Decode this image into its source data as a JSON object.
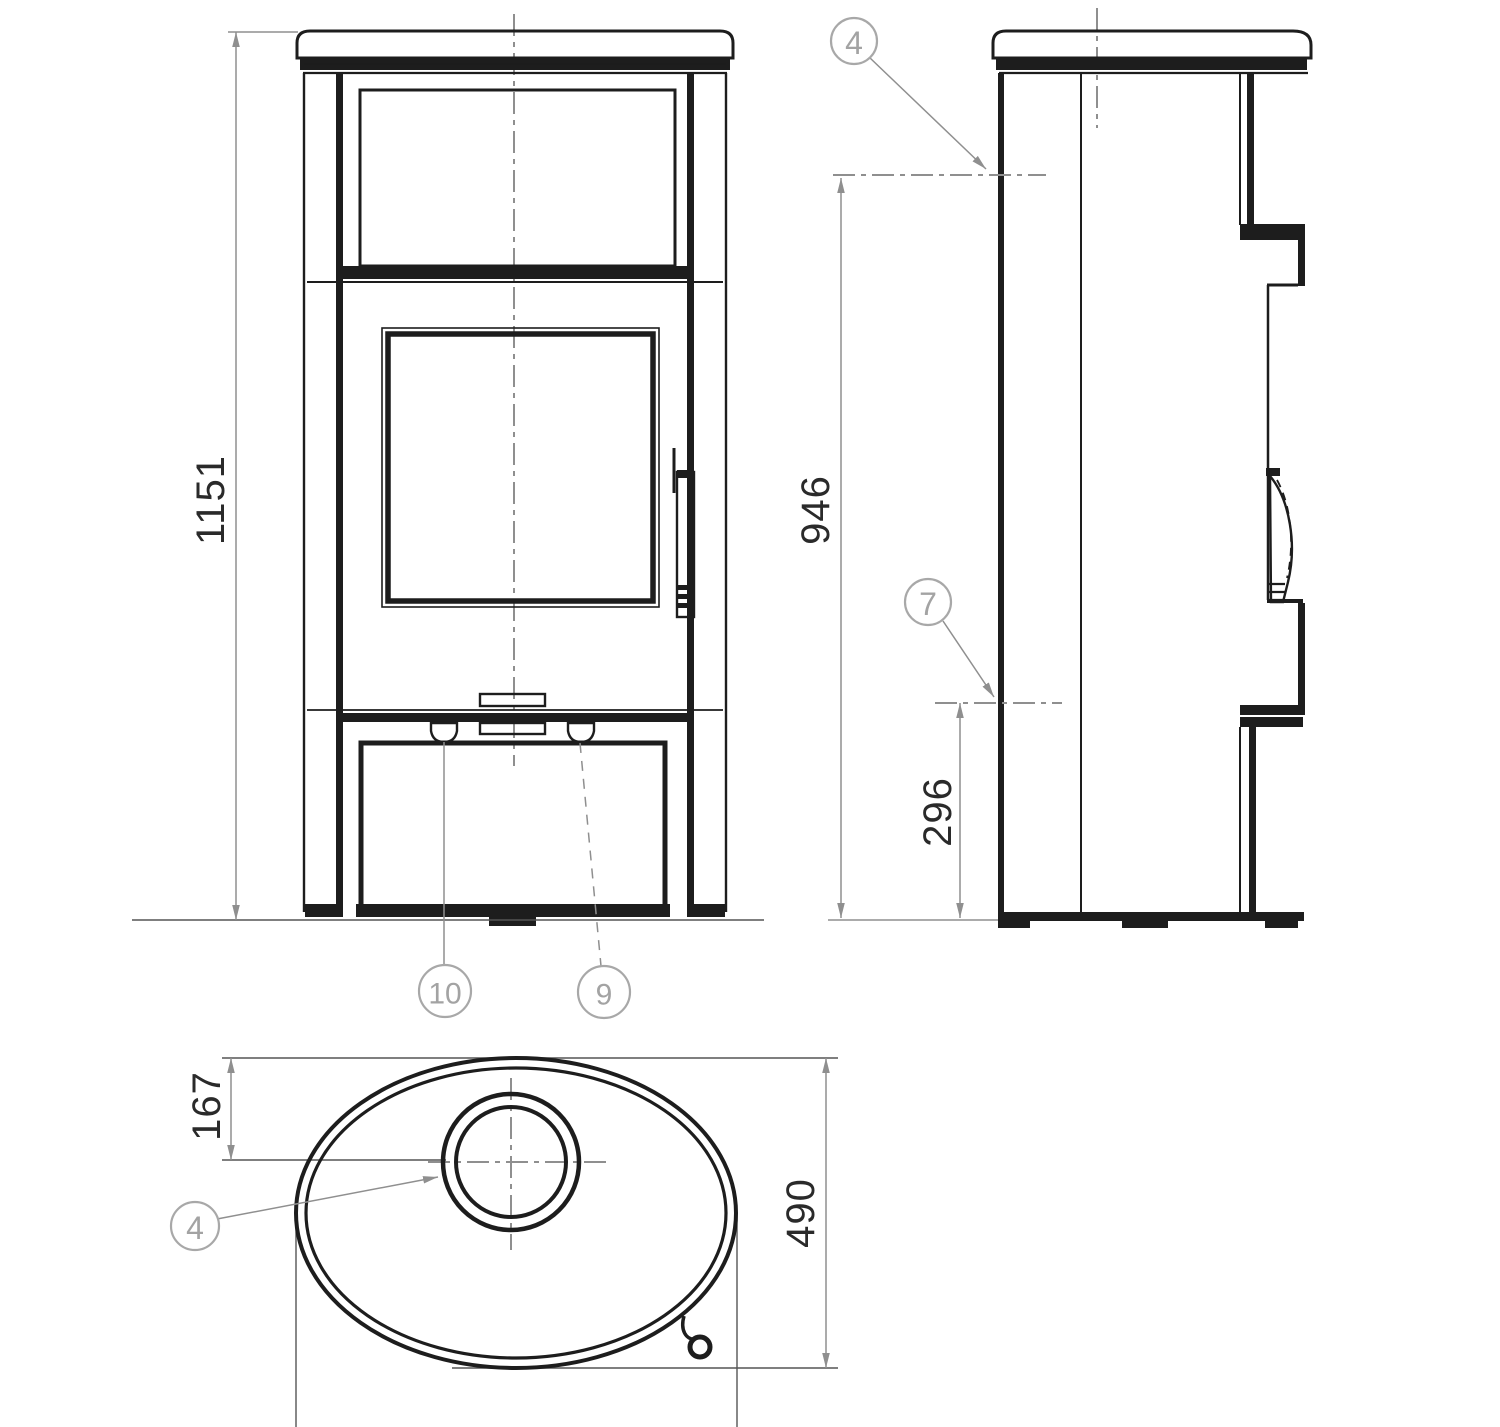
{
  "drawing": {
    "background": "#ffffff",
    "line_color": "#1d1d1d",
    "dim_color": "#8f8f8f",
    "dim_text_color": "#2a2a2a",
    "callout_color": "#a3a3a3",
    "views": {
      "front": {
        "name": "stove front view"
      },
      "side": {
        "name": "stove side view"
      },
      "top": {
        "name": "stove top view"
      }
    },
    "dimensions": {
      "overall_height": {
        "value": "1151",
        "view": "front",
        "orientation": "vertical"
      },
      "flue_outlet_height": {
        "value": "946",
        "view": "side",
        "orientation": "vertical"
      },
      "lower_outlet_height": {
        "value": "296",
        "view": "side",
        "orientation": "vertical"
      },
      "flue_center_offset": {
        "value": "167",
        "view": "top",
        "orientation": "vertical"
      },
      "depth": {
        "value": "490",
        "view": "top",
        "orientation": "vertical"
      }
    },
    "callouts": {
      "side_flue_outlet": {
        "label": "4"
      },
      "side_lower_outlet": {
        "label": "7"
      },
      "front_left_knob": {
        "label": "10"
      },
      "front_right_knob": {
        "label": "9"
      },
      "top_flue_collar": {
        "label": "4"
      }
    }
  }
}
